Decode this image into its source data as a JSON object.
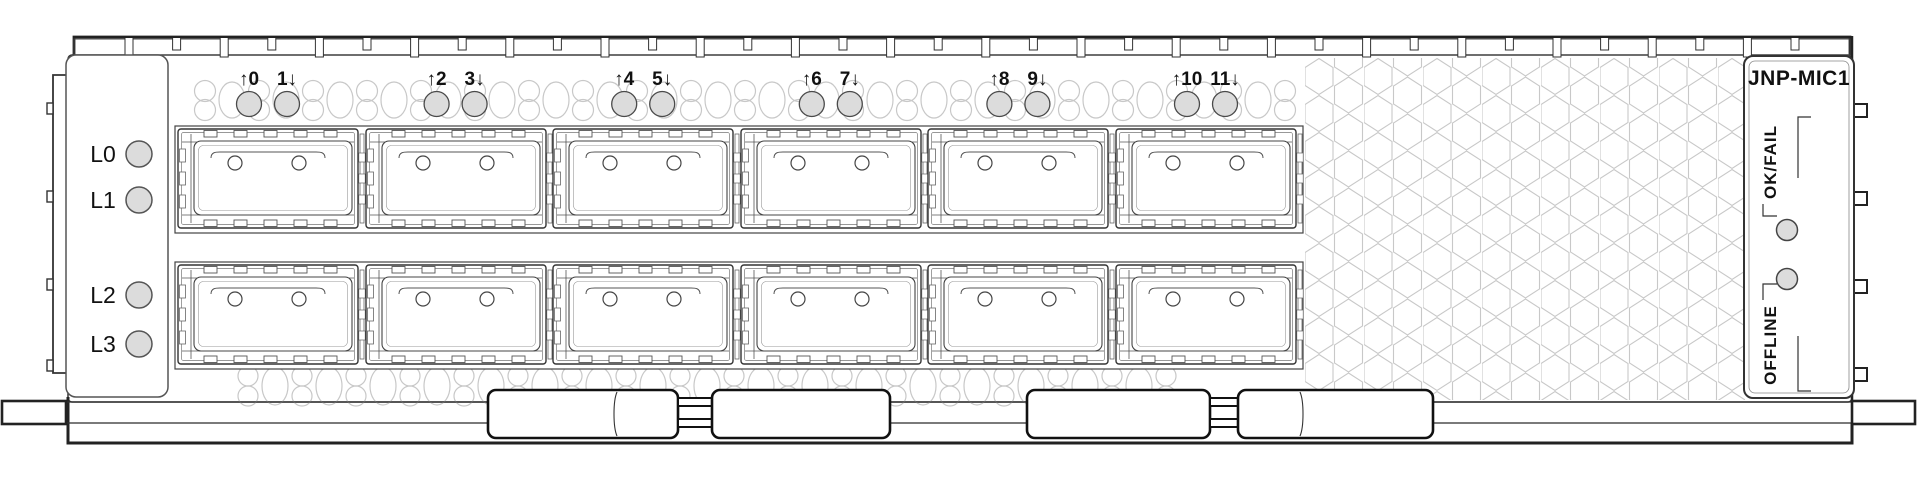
{
  "module": {
    "type_label": "network interface card faceplate",
    "port_count": 12,
    "cage_rows": 2,
    "cages_per_row": 6
  },
  "left_panel": {
    "lane_leds": [
      {
        "label": "L0"
      },
      {
        "label": "L1"
      },
      {
        "label": "L2"
      },
      {
        "label": "L3"
      }
    ]
  },
  "port_led_labels": [
    {
      "label": "↑0"
    },
    {
      "label": "1↓"
    },
    {
      "label": "↑2"
    },
    {
      "label": "3↓"
    },
    {
      "label": "↑4"
    },
    {
      "label": "5↓"
    },
    {
      "label": "↑6"
    },
    {
      "label": "7↓"
    },
    {
      "label": "↑8"
    },
    {
      "label": "9↓"
    },
    {
      "label": "↑10"
    },
    {
      "label": "11↓"
    }
  ],
  "right_panel": {
    "model_label": "JNP-MIC1",
    "ok_fail_label": "OK/FAIL",
    "offline_label": "OFFLINE"
  },
  "colors": {
    "background": "#ffffff",
    "line": "#333333",
    "heavy_line": "#1a1a1a",
    "vent_line": "#c8c8c8",
    "led_fill": "#dcdcdc",
    "led_stroke": "#4a4a4a"
  }
}
